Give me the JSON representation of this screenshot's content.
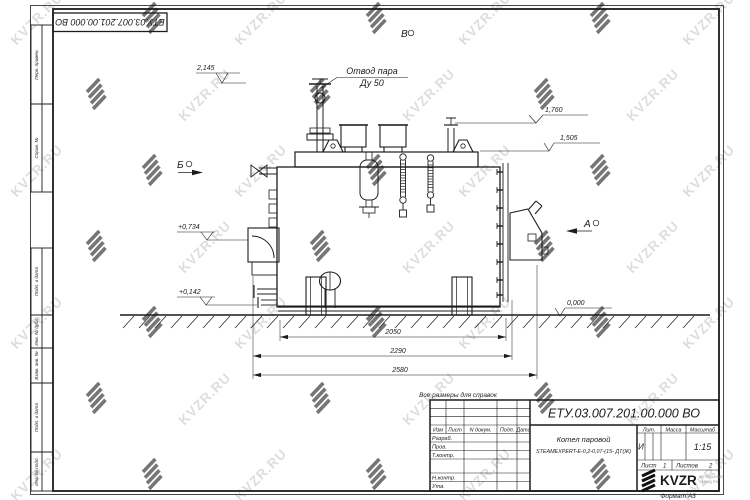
{
  "watermark": {
    "text": "KVZR.RU",
    "color": "#c8c8c8"
  },
  "stamp_top": {
    "doc_number": "ЕТУ.03.007.201.00.000  ВО"
  },
  "margin_labels": {
    "perv": "Перв. примен.",
    "sprav": "Справ. №",
    "podp1": "Подп. и дата",
    "inv_dubl": "Инв. № дубл.",
    "vzam": "Взам. инв. №",
    "podp2": "Подп. и дата",
    "inv_podl": "Инв. № подл."
  },
  "drawing": {
    "labels": {
      "steam_outlet_line1": "Отвод пара",
      "steam_outlet_line2": "Ду 50"
    },
    "views": {
      "view_b": "Б",
      "view_a": "А",
      "view_v": "В"
    },
    "elevations": {
      "e1": "2,145",
      "e2": "1,760",
      "e3": "1,505",
      "e4": "+0,734",
      "e5": "+0,142",
      "e6": "0,000"
    },
    "dimensions": {
      "d1": "2050",
      "d2": "2290",
      "d3": "2580"
    },
    "note": "Все размеры для справок"
  },
  "title_block": {
    "doc_number": "ЕТУ.03.007.201.00.000  ВО",
    "product_line1": "Котел паровой",
    "product_line2": "STEAMEXPERT-E-0,2-0,07-(15- ДТ(Ж)",
    "header": {
      "izm": "Изм",
      "list": "Лист",
      "n_dokum": "N докум.",
      "podp": "Подп.",
      "data": "Дата"
    },
    "rows": {
      "razrab": "Разраб.",
      "prov": "Пров.",
      "t_kontr": "Т.контр.",
      "n_kontr": "Н.контр.",
      "utv": "Утв."
    },
    "lit_header": "Лит.",
    "massa_header": "Масса",
    "masshtab_header": "Масштаб",
    "lit_value": "И",
    "scale_value": "1:15",
    "list_label": "Лист",
    "list_value": "1",
    "listov_label": "Листов",
    "listov_value": "2",
    "logo_text": "KVZR",
    "logo_sub1": "КОТЕЛЬНЫЙ",
    "logo_sub2": "ЗАВОД.РФ",
    "format_label": "Формат А3"
  }
}
